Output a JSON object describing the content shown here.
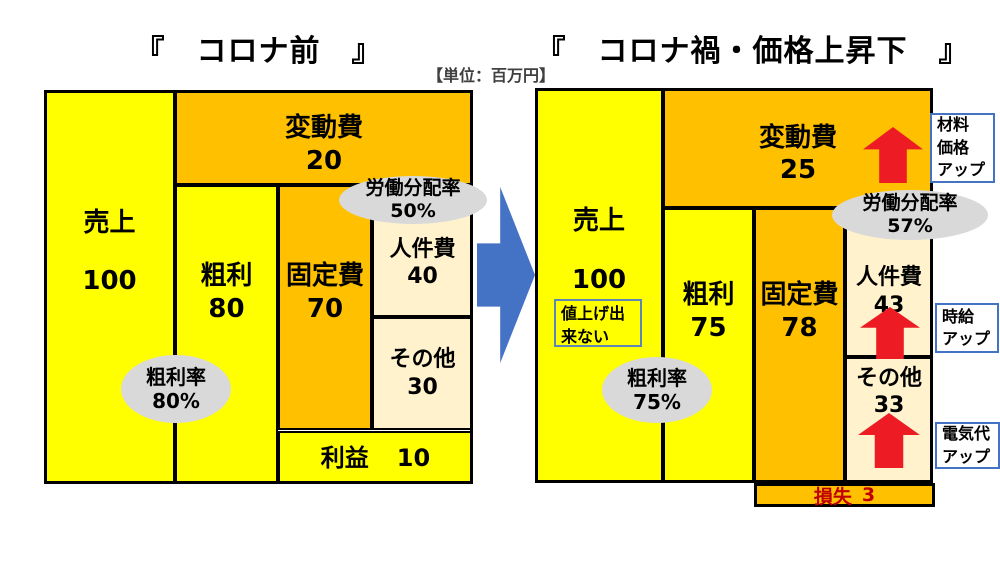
{
  "unit_label": "【単位：百万円】",
  "colors": {
    "yellow": "#FFFF00",
    "orange": "#FFC000",
    "cream": "#FFF2CC",
    "badge_gray": "#D9D9D9",
    "arrow_red": "#ED1C24",
    "arrow_blue": "#4472C4",
    "callout_border_blue": "#4472C4",
    "loss_text_red": "#C00000"
  },
  "left": {
    "title": "『　コロナ前　』",
    "boxes": {
      "sales": {
        "label": "売上",
        "value": "100"
      },
      "variable": {
        "label": "変動費",
        "value": "20"
      },
      "gross": {
        "label": "粗利",
        "value": "80"
      },
      "fixed": {
        "label": "固定費",
        "value": "70"
      },
      "labor": {
        "label": "人件費",
        "value": "40"
      },
      "other": {
        "label": "その他",
        "value": "30"
      },
      "profit": {
        "label": "利益",
        "value": "10"
      }
    },
    "badges": {
      "labor_share": {
        "line1": "労働分配率",
        "line2": "50%"
      },
      "gross_margin": {
        "line1": "粗利率",
        "line2": "80%"
      }
    }
  },
  "right": {
    "title": "『　コロナ禍・価格上昇下　』",
    "boxes": {
      "sales": {
        "label": "売上",
        "value": "100"
      },
      "variable": {
        "label": "変動費",
        "value": "25"
      },
      "gross": {
        "label": "粗利",
        "value": "75"
      },
      "fixed": {
        "label": "固定費",
        "value": "78"
      },
      "labor": {
        "label": "人件費",
        "value": "43"
      },
      "other": {
        "label": "その他",
        "value": "33"
      },
      "loss": {
        "label": "損失",
        "value": "3"
      }
    },
    "badges": {
      "labor_share": {
        "line1": "労働分配率",
        "line2": "57%"
      },
      "gross_margin": {
        "line1": "粗利率",
        "line2": "75%"
      }
    },
    "note": "値上げ出来ない",
    "callouts": [
      {
        "lines": [
          "材料",
          "価格",
          "アップ"
        ]
      },
      {
        "lines": [
          "時給",
          "アップ"
        ]
      },
      {
        "lines": [
          "電気代",
          "アップ"
        ]
      }
    ]
  }
}
